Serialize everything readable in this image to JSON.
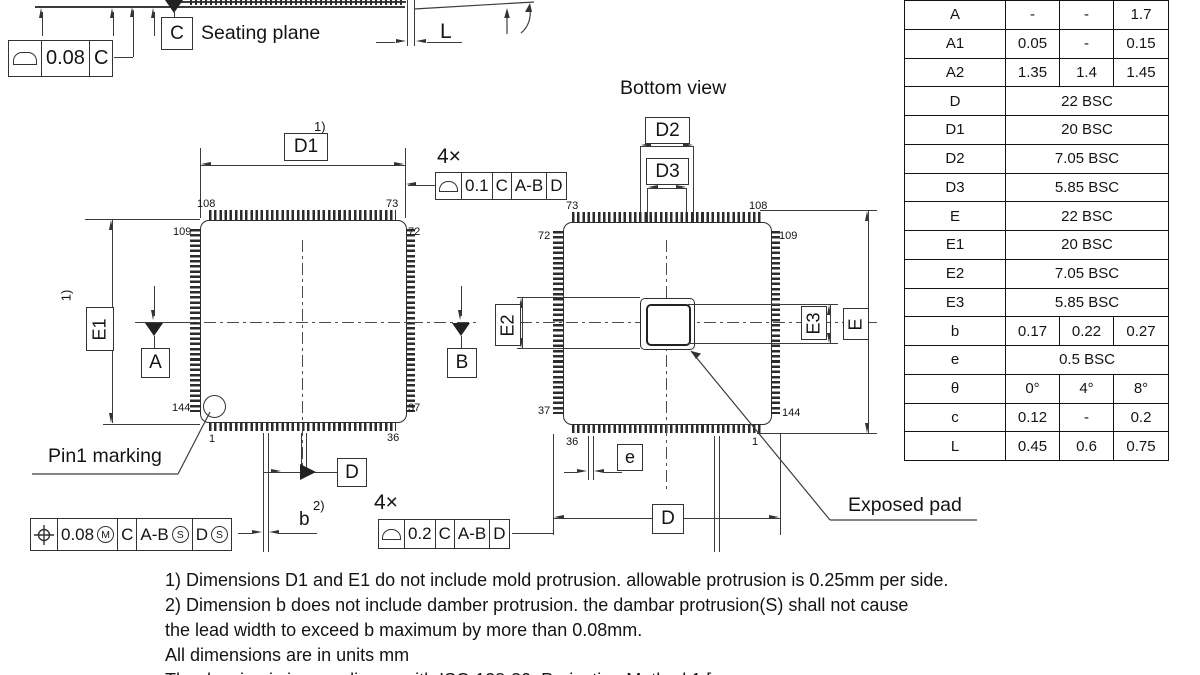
{
  "top_detail": {
    "seating_plane_label": "Seating plane",
    "datum_c": "C",
    "flatness_fcf": {
      "value": "0.08",
      "datum": "C"
    },
    "l_label": "L"
  },
  "top_view": {
    "d1_label": "D1",
    "d1_note": "1)",
    "e1_label": "E1",
    "e1_note": "1)",
    "datum_a": "A",
    "datum_b": "B",
    "datum_d": "D",
    "b_label": "b",
    "b_note": "2)",
    "pin1_label": "Pin1 marking",
    "pins": {
      "top_left": "108",
      "top_right": "73",
      "left_top": "109",
      "right_top": "72",
      "left_bottom": "144",
      "right_bottom": "37",
      "bottom_left": "1",
      "bottom_right": "36"
    },
    "profile_fcf": {
      "count": "4×",
      "value": "0.1",
      "ref1": "C",
      "ref2": "A-B",
      "ref3": "D"
    },
    "position_fcf": {
      "value": "0.08",
      "modifier": "M",
      "ref1": "C",
      "ref2": "A-B",
      "ref2_mod": "S",
      "ref3": "D",
      "ref3_mod": "S"
    }
  },
  "bottom_view": {
    "title": "Bottom view",
    "d2_label": "D2",
    "d3_label": "D3",
    "e2_label": "E2",
    "e3_label": "E3",
    "e_label": "E",
    "d_label": "D",
    "pitch_label": "e",
    "exposed_pad_label": "Exposed pad",
    "pins": {
      "top_left": "73",
      "top_right": "108",
      "left_top": "72",
      "right_top": "109",
      "left_bottom": "37",
      "right_bottom": "144",
      "bottom_left": "36",
      "bottom_right": "1"
    },
    "profile_fcf": {
      "count": "4×",
      "value": "0.2",
      "ref1": "C",
      "ref2": "A-B",
      "ref3": "D"
    }
  },
  "notes": {
    "line1": "1) Dimensions D1 and E1 do not include mold protrusion. allowable protrusion is 0.25mm per side.",
    "line2": "2) Dimension b does not include damber protrusion. the dambar protrusion(S) shall not cause",
    "line3": "the lead width to exceed b maximum by more than 0.08mm.",
    "line4": "All dimensions are in units mm",
    "line5": "The drawing is in compliance with ISO 128-30. Projection Method 1 ["
  },
  "dim_table": {
    "rows": [
      {
        "symbol": "A",
        "min": "-",
        "typ": "-",
        "max": "1.7"
      },
      {
        "symbol": "A1",
        "min": "0.05",
        "typ": "-",
        "max": "0.15"
      },
      {
        "symbol": "A2",
        "min": "1.35",
        "typ": "1.4",
        "max": "1.45"
      },
      {
        "symbol": "D",
        "span": "22 BSC"
      },
      {
        "symbol": "D1",
        "span": "20 BSC"
      },
      {
        "symbol": "D2",
        "span": "7.05 BSC"
      },
      {
        "symbol": "D3",
        "span": "5.85 BSC"
      },
      {
        "symbol": "E",
        "span": "22 BSC"
      },
      {
        "symbol": "E1",
        "span": "20 BSC"
      },
      {
        "symbol": "E2",
        "span": "7.05 BSC"
      },
      {
        "symbol": "E3",
        "span": "5.85 BSC"
      },
      {
        "symbol": "b",
        "min": "0.17",
        "typ": "0.22",
        "max": "0.27"
      },
      {
        "symbol": "e",
        "span": "0.5 BSC"
      },
      {
        "symbol": "θ",
        "min": "0°",
        "typ": "4°",
        "max": "8°"
      },
      {
        "symbol": "c",
        "min": "0.12",
        "typ": "-",
        "max": "0.2"
      },
      {
        "symbol": "L",
        "min": "0.45",
        "typ": "0.6",
        "max": "0.75"
      }
    ]
  }
}
